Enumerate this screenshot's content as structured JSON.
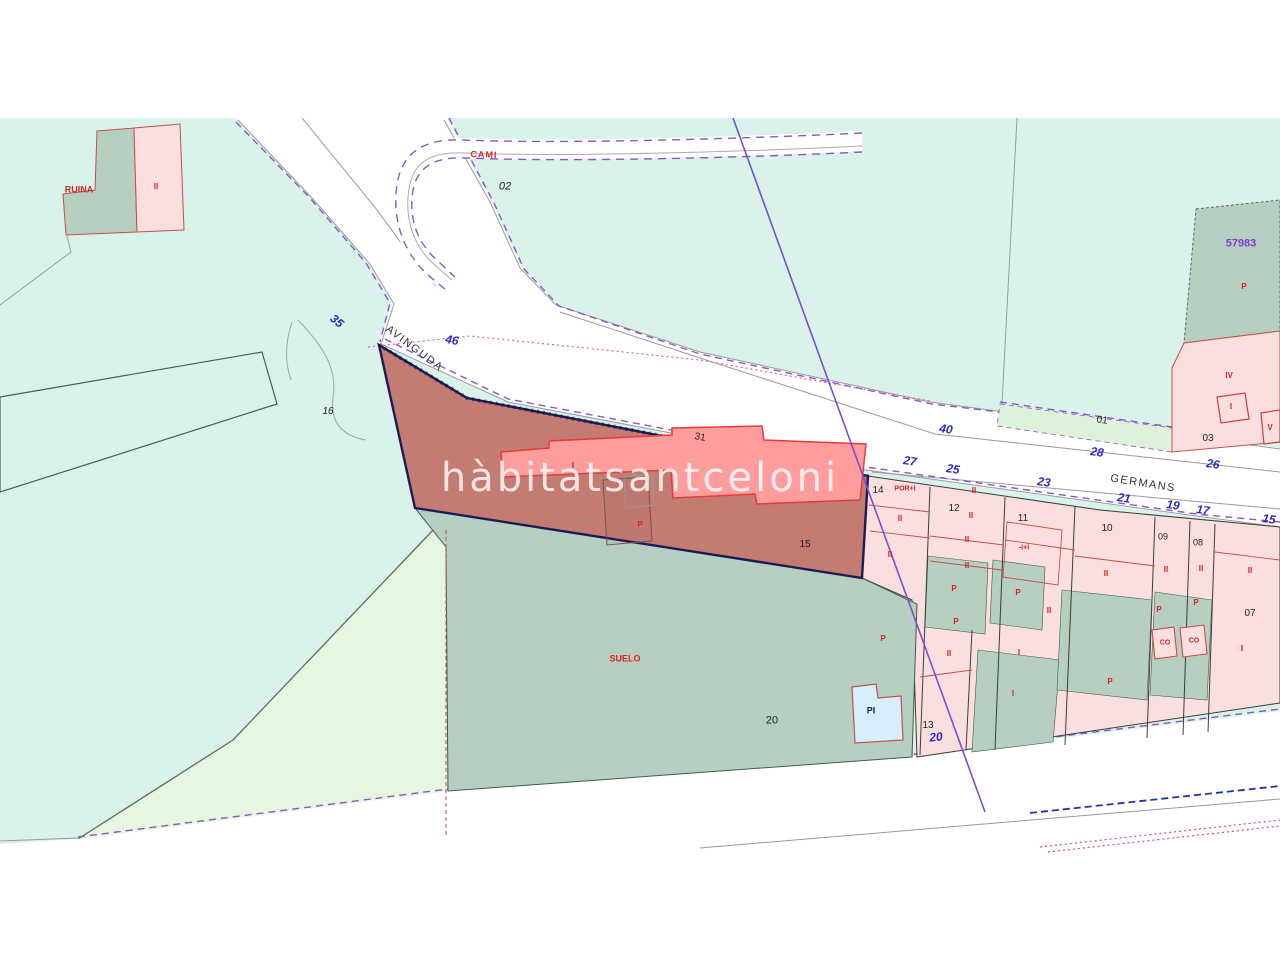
{
  "watermark": {
    "text": "hàbitatsantceloni"
  },
  "colors": {
    "background": "#ffffff",
    "terrain_teal": "#d9f2ea",
    "terrain_light_green": "#e7f6df",
    "strip_green": "#ddf2d8",
    "parcel_green_gray": "#b6cfc0",
    "parcel_pink": "#fbdede",
    "subject_parcel": "#c47b72",
    "subject_building": "#ff9d9d",
    "building_border": "#e43c3c",
    "subject_border": "#1b1b55",
    "road_gray": "#9a9a9a",
    "boundary_purple": "#8b55cc",
    "diagonal_purple": "#7a4fd0",
    "street_number_blue": "#2a2ac8",
    "code_red": "#d42424",
    "ref_purple": "#7b3fd0",
    "pool_blue": "#d6effa",
    "magenta_dotted": "#e0409a",
    "blue_dashed": "#2233aa"
  },
  "map": {
    "street_names": [
      "AVINGUDA",
      "GERMANS",
      "CAMI"
    ],
    "cadastral_ref": "57983",
    "labels": [
      {
        "t": "AVINGUDA",
        "x": 414,
        "y": 349,
        "c": "street-black",
        "s": 11,
        "r": 37
      },
      {
        "t": "GERMANS",
        "x": 1143,
        "y": 484,
        "c": "street-black",
        "s": 11,
        "r": 9
      },
      {
        "t": "CAMI",
        "x": 484,
        "y": 155,
        "c": "street-red",
        "s": 9,
        "r": 2
      },
      {
        "t": "35",
        "x": 337,
        "y": 321,
        "c": "num-blue",
        "s": 12,
        "r": 40
      },
      {
        "t": "46",
        "x": 452,
        "y": 340,
        "c": "num-blue",
        "s": 12,
        "r": 10
      },
      {
        "t": "40",
        "x": 946,
        "y": 429,
        "c": "num-blue",
        "s": 12,
        "r": 8
      },
      {
        "t": "28",
        "x": 1097,
        "y": 452,
        "c": "num-blue",
        "s": 12,
        "r": 8
      },
      {
        "t": "26",
        "x": 1213,
        "y": 464,
        "c": "num-blue",
        "s": 12,
        "r": 8
      },
      {
        "t": "27",
        "x": 910,
        "y": 461,
        "c": "num-blue",
        "s": 12,
        "r": 8
      },
      {
        "t": "25",
        "x": 953,
        "y": 469,
        "c": "num-blue",
        "s": 12,
        "r": 8
      },
      {
        "t": "23",
        "x": 1044,
        "y": 482,
        "c": "num-blue",
        "s": 12,
        "r": 8
      },
      {
        "t": "21",
        "x": 1124,
        "y": 498,
        "c": "num-blue",
        "s": 12,
        "r": 8
      },
      {
        "t": "19",
        "x": 1173,
        "y": 505,
        "c": "num-blue",
        "s": 12,
        "r": 8
      },
      {
        "t": "17",
        "x": 1203,
        "y": 510,
        "c": "num-blue",
        "s": 12,
        "r": 8
      },
      {
        "t": "15",
        "x": 1269,
        "y": 519,
        "c": "num-blue",
        "s": 12,
        "r": 8
      },
      {
        "t": "20",
        "x": 936,
        "y": 737,
        "c": "num-blue",
        "s": 12,
        "r": -6
      },
      {
        "t": "02",
        "x": 505,
        "y": 187,
        "c": "num-italic",
        "s": 11,
        "r": 0
      },
      {
        "t": "16",
        "x": 328,
        "y": 412,
        "c": "num-italic",
        "s": 10,
        "r": 0
      },
      {
        "t": "01",
        "x": 1102,
        "y": 421,
        "c": "num-black",
        "s": 10,
        "r": 8
      },
      {
        "t": "03",
        "x": 1208,
        "y": 439,
        "c": "num-black",
        "s": 10,
        "r": 0
      },
      {
        "t": "31",
        "x": 700,
        "y": 438,
        "c": "num-black",
        "s": 10,
        "r": 10
      },
      {
        "t": "14",
        "x": 878,
        "y": 491,
        "c": "num-black",
        "s": 10,
        "r": 0
      },
      {
        "t": "12",
        "x": 954,
        "y": 509,
        "c": "num-black",
        "s": 10,
        "r": 0
      },
      {
        "t": "11",
        "x": 1023,
        "y": 519,
        "c": "num-black",
        "s": 10,
        "r": 0
      },
      {
        "t": "10",
        "x": 1107,
        "y": 529,
        "c": "num-black",
        "s": 10,
        "r": 0
      },
      {
        "t": "09",
        "x": 1163,
        "y": 537,
        "c": "num-black",
        "s": 9,
        "r": 0
      },
      {
        "t": "08",
        "x": 1198,
        "y": 543,
        "c": "num-black",
        "s": 9,
        "r": 0
      },
      {
        "t": "07",
        "x": 1250,
        "y": 614,
        "c": "num-black",
        "s": 10,
        "r": 0
      },
      {
        "t": "13",
        "x": 928,
        "y": 726,
        "c": "num-black",
        "s": 10,
        "r": 0
      },
      {
        "t": "15",
        "x": 805,
        "y": 545,
        "c": "num-black",
        "s": 10,
        "r": 0
      },
      {
        "t": "20",
        "x": 772,
        "y": 721,
        "c": "num-black",
        "s": 11,
        "r": 0
      },
      {
        "t": "PI",
        "x": 871,
        "y": 711,
        "c": "num-bold",
        "s": 9,
        "r": 0
      },
      {
        "t": "I",
        "x": 573,
        "y": 466,
        "c": "num-black",
        "s": 8,
        "r": 0
      },
      {
        "t": "RUINA",
        "x": 79,
        "y": 190,
        "c": "code-red",
        "s": 9,
        "r": 0
      },
      {
        "t": "II",
        "x": 156,
        "y": 187,
        "c": "code-red",
        "s": 8,
        "r": 0
      },
      {
        "t": "SUELO",
        "x": 625,
        "y": 659,
        "c": "code-red",
        "s": 9,
        "r": 0
      },
      {
        "t": "P",
        "x": 640,
        "y": 525,
        "c": "code-red",
        "s": 8,
        "r": 0
      },
      {
        "t": "POR+I",
        "x": 905,
        "y": 489,
        "c": "code-red",
        "s": 7,
        "r": 0
      },
      {
        "t": "II",
        "x": 974,
        "y": 491,
        "c": "code-red",
        "s": 8,
        "r": 0
      },
      {
        "t": "II",
        "x": 900,
        "y": 519,
        "c": "code-red",
        "s": 8,
        "r": 0
      },
      {
        "t": "II",
        "x": 971,
        "y": 516,
        "c": "code-red",
        "s": 8,
        "r": 0
      },
      {
        "t": "II",
        "x": 967,
        "y": 540,
        "c": "code-red",
        "s": 8,
        "r": 0
      },
      {
        "t": "II",
        "x": 890,
        "y": 555,
        "c": "code-red",
        "s": 8,
        "r": 0
      },
      {
        "t": "II",
        "x": 967,
        "y": 566,
        "c": "code-red",
        "s": 8,
        "r": 0
      },
      {
        "t": "P",
        "x": 954,
        "y": 589,
        "c": "code-red",
        "s": 8,
        "r": 0
      },
      {
        "t": "P",
        "x": 956,
        "y": 622,
        "c": "code-red",
        "s": 8,
        "r": 0
      },
      {
        "t": "II",
        "x": 949,
        "y": 654,
        "c": "code-red",
        "s": 8,
        "r": 0
      },
      {
        "t": "P",
        "x": 883,
        "y": 639,
        "c": "code-red",
        "s": 8,
        "r": 0
      },
      {
        "t": "-I+I",
        "x": 1024,
        "y": 548,
        "c": "code-red",
        "s": 7,
        "r": 0
      },
      {
        "t": "P",
        "x": 1018,
        "y": 593,
        "c": "code-red",
        "s": 8,
        "r": 0
      },
      {
        "t": "II",
        "x": 1049,
        "y": 611,
        "c": "code-red",
        "s": 8,
        "r": 0
      },
      {
        "t": "I",
        "x": 1019,
        "y": 653,
        "c": "code-red",
        "s": 8,
        "r": 0
      },
      {
        "t": "I",
        "x": 1013,
        "y": 694,
        "c": "code-red",
        "s": 8,
        "r": 0
      },
      {
        "t": "P",
        "x": 1110,
        "y": 682,
        "c": "code-red",
        "s": 8,
        "r": 0
      },
      {
        "t": "II",
        "x": 1106,
        "y": 574,
        "c": "code-red",
        "s": 8,
        "r": 0
      },
      {
        "t": "II",
        "x": 1166,
        "y": 570,
        "c": "code-red",
        "s": 8,
        "r": 0
      },
      {
        "t": "II",
        "x": 1201,
        "y": 569,
        "c": "code-red",
        "s": 8,
        "r": 0
      },
      {
        "t": "II",
        "x": 1250,
        "y": 571,
        "c": "code-red",
        "s": 8,
        "r": 0
      },
      {
        "t": "P",
        "x": 1159,
        "y": 610,
        "c": "code-red",
        "s": 8,
        "r": 0
      },
      {
        "t": "P",
        "x": 1196,
        "y": 603,
        "c": "code-red",
        "s": 8,
        "r": 0
      },
      {
        "t": "CO",
        "x": 1165,
        "y": 643,
        "c": "code-red",
        "s": 7,
        "r": 0
      },
      {
        "t": "CO",
        "x": 1194,
        "y": 641,
        "c": "code-red",
        "s": 7,
        "r": 0
      },
      {
        "t": "I",
        "x": 1242,
        "y": 649,
        "c": "code-red",
        "s": 8,
        "r": 0
      },
      {
        "t": "P",
        "x": 1244,
        "y": 287,
        "c": "code-red",
        "s": 8,
        "r": 0
      },
      {
        "t": "IV",
        "x": 1229,
        "y": 376,
        "c": "code-red",
        "s": 8,
        "r": 0
      },
      {
        "t": "I",
        "x": 1231,
        "y": 407,
        "c": "code-red",
        "s": 8,
        "r": 0
      },
      {
        "t": "V",
        "x": 1270,
        "y": 428,
        "c": "code-red",
        "s": 8,
        "r": 0
      },
      {
        "t": "57983",
        "x": 1241,
        "y": 244,
        "c": "ref-purple",
        "s": 11,
        "r": 0
      }
    ]
  }
}
